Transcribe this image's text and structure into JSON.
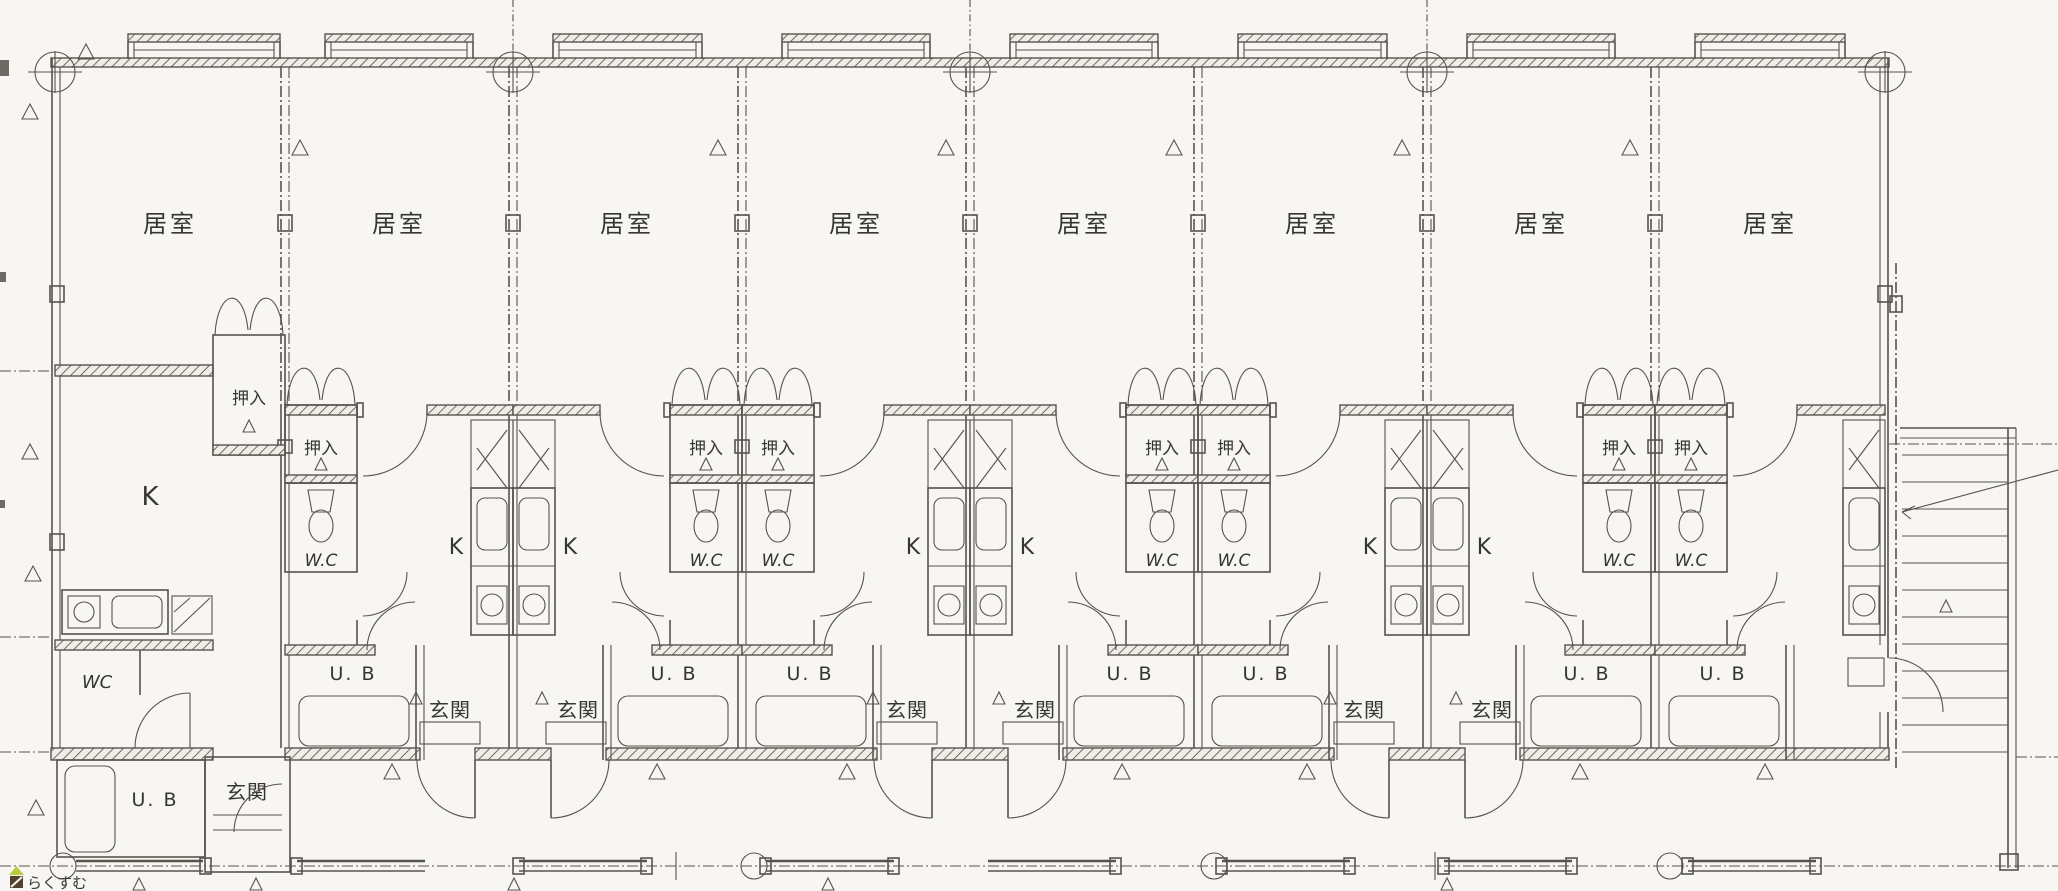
{
  "palette": {
    "paper": "#f7f6f2",
    "ink": "#56544d",
    "text": "#36352f",
    "watermark_text": "#b9895f",
    "watermark_icon_dark": "#52412d",
    "watermark_icon_green": "#b9cc41"
  },
  "labels": {
    "living": "居室",
    "closet": "押入",
    "kitchen": "K",
    "toilet": "W.C",
    "toilet_unit1": "WC",
    "bath": "U. B",
    "entrance": "玄関"
  },
  "watermark": {
    "text": "らくすむ"
  },
  "units": {
    "count": 8
  },
  "icons": {
    "triangle-marker": "open triangle glyph drawn at walls, doors and ground line",
    "column-marker": "circle with crosshair on structural grid",
    "futon-closet-doors": "two petal arcs above closet",
    "door-swing": "quarter-circle arc with leaf line",
    "toilet": "tank trapezoid with bowl ellipse",
    "bathtub": "rounded rectangle",
    "stove": "square with circle burner",
    "sink": "rounded rectangle",
    "stairs": "parallel treads with diagonal direction line",
    "fence": "thick double line segments with square posts on dash-dot ground line"
  }
}
